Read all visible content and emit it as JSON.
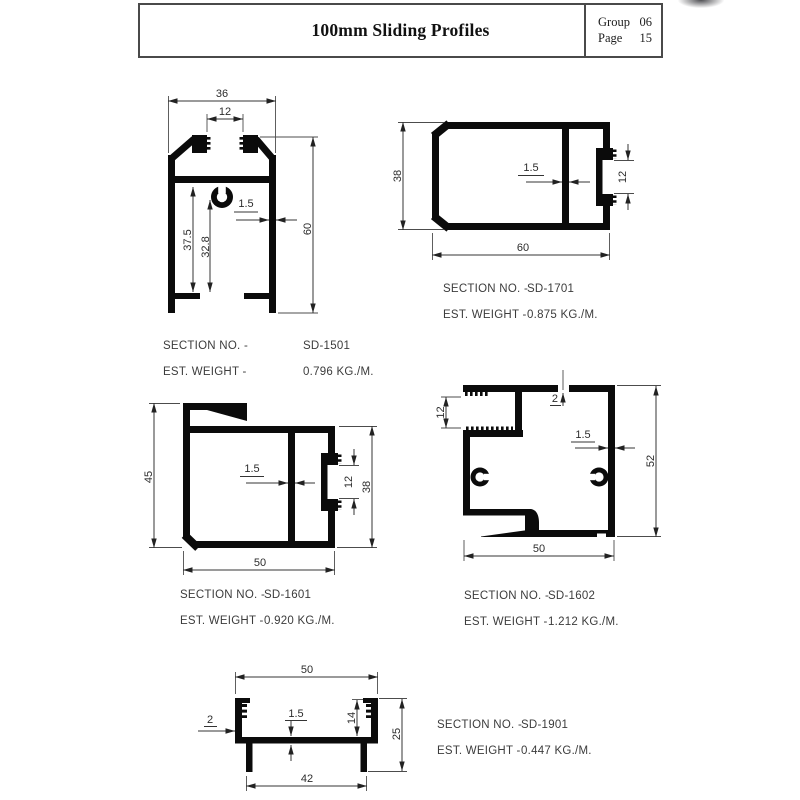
{
  "header": {
    "title": "100mm Sliding Profiles",
    "group_label": "Group",
    "group_value": "06",
    "page_label": "Page",
    "page_value": "15"
  },
  "captions": {
    "section_label": "SECTION NO. -",
    "weight_label": "EST. WEIGHT -"
  },
  "profiles": [
    {
      "section_no": "SD-1501",
      "weight": "0.796 KG./M.",
      "dims": {
        "outer_width": "36",
        "top_slot": "12",
        "height": "60",
        "web_depth": "37.5",
        "clip_depth": "32.8",
        "wall": "1.5"
      }
    },
    {
      "section_no": "SD-1701",
      "weight": "0.875 KG./M.",
      "dims": {
        "height": "38",
        "wall": "1.5",
        "groove": "12",
        "width": "60"
      }
    },
    {
      "section_no": "SD-1601",
      "weight": "0.920 KG./M.",
      "dims": {
        "height": "45",
        "wall": "1.5",
        "groove": "12",
        "right_height": "38",
        "width": "50"
      }
    },
    {
      "section_no": "SD-1602",
      "weight": "1.212 KG./M.",
      "dims": {
        "pocket": "12",
        "top_wall": "2",
        "wall": "1.5",
        "height": "52",
        "width": "50"
      }
    },
    {
      "section_no": "SD-1901",
      "weight": "0.447 KG./M.",
      "dims": {
        "top_width": "50",
        "side_wall": "2",
        "base_wall": "1.5",
        "channel_height": "14",
        "height": "25",
        "leg_span": "42"
      }
    }
  ]
}
